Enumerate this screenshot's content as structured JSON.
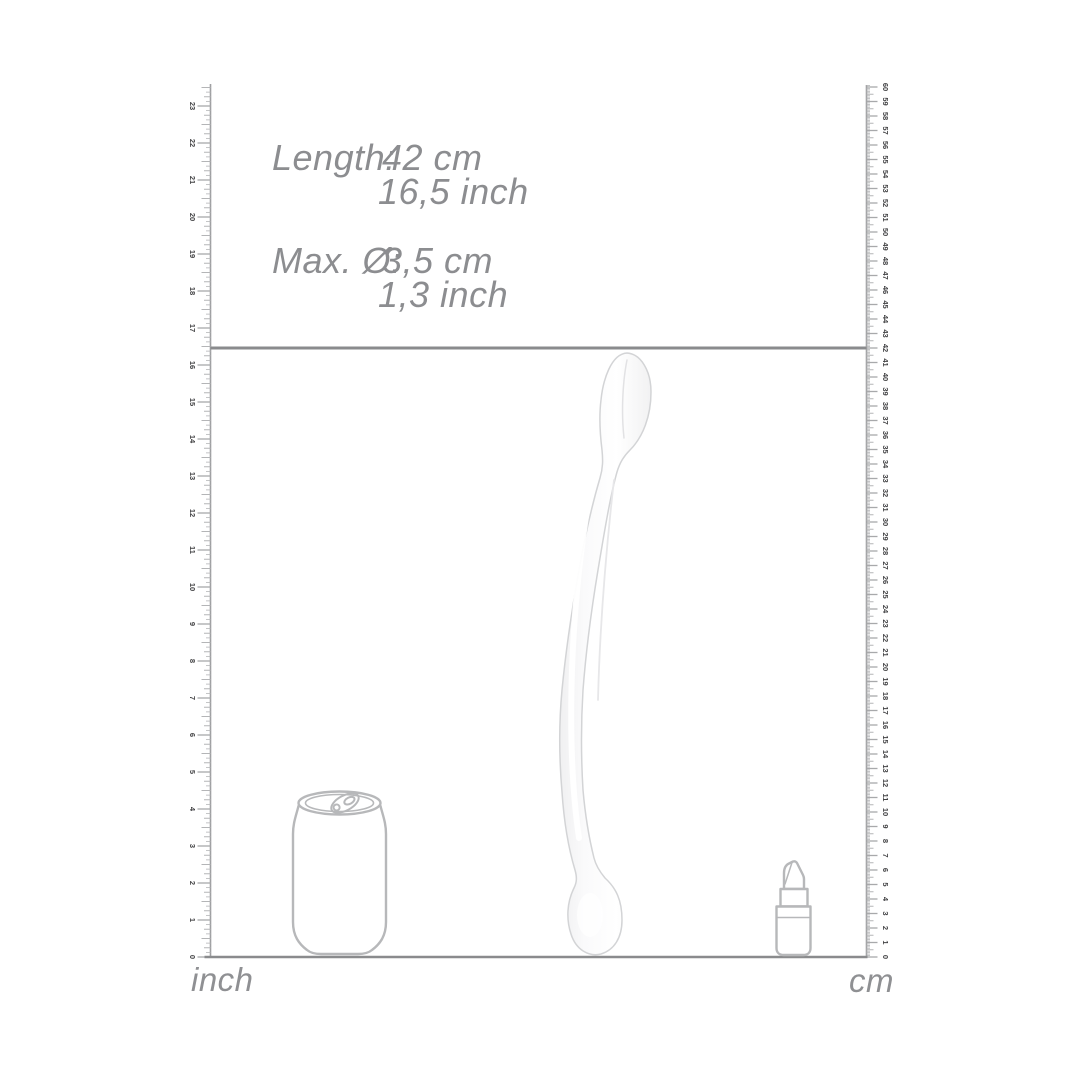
{
  "diagram": {
    "length": {
      "label": "Length:",
      "value_cm": "42 cm",
      "value_inch": "16,5 inch"
    },
    "diameter": {
      "label": "Max. Ø:",
      "value_cm": "3,5 cm",
      "value_inch": "1,3 inch"
    }
  },
  "rulers": {
    "left": {
      "unit_label": "inch",
      "min": 0,
      "max": 23
    },
    "right": {
      "unit_label": "cm",
      "min": 0,
      "max": 60
    }
  },
  "marker": {
    "length_cm": 42,
    "length_inch": 16.5
  },
  "product": "transparent double-ended dildo",
  "reference_objects": [
    "soda-can",
    "lipstick"
  ],
  "colors": {
    "background": "#ffffff",
    "text_gray": "#8c8d90",
    "ruler_line": "#9fa0a2",
    "tick_minor": "#b4b5b7",
    "tick_major": "#a8a9ab",
    "number_dark": "#414143",
    "marker_line": "#8a8b8d",
    "object_outline": "#b7b8ba",
    "product_stroke": "#d3d4d6"
  }
}
